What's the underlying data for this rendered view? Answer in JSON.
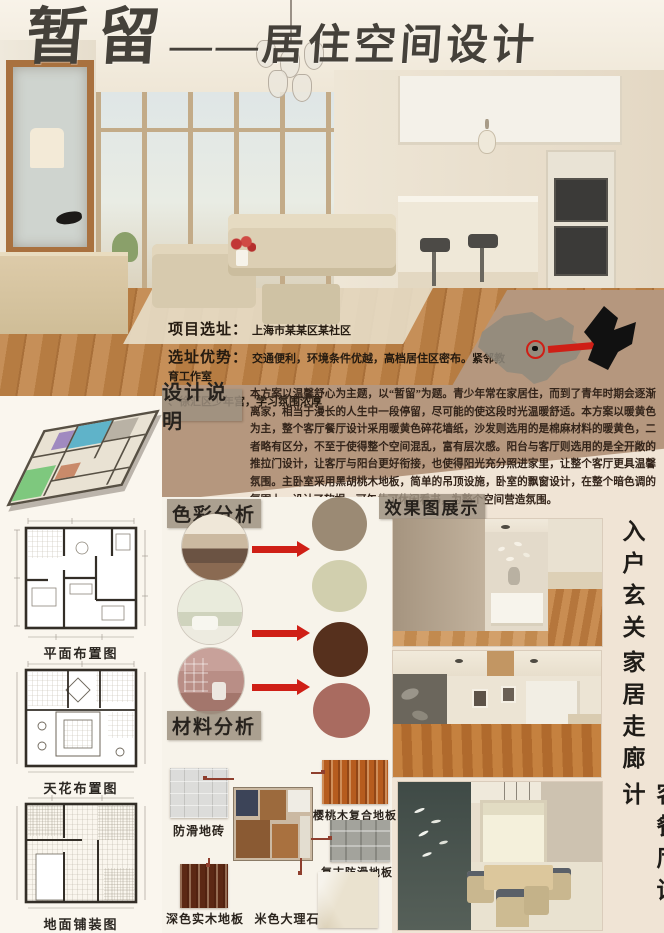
{
  "title": {
    "main": "暂留",
    "separator": "——",
    "sub": "居住空间设计"
  },
  "project": {
    "location_label": "项目选址：",
    "location_value": "上海市某某区某社区",
    "advantage_label": "选址优势：",
    "advantage_value": "交通便利，环境条件优越，高档居住区密布。紧邻教育工作室",
    "advantage_value2": "、徐汇区少年宫，学习氛围浓厚"
  },
  "design_notes": {
    "label": "设计说明",
    "body": "本方案以温馨舒心为主题，以“暂留”为题。青少年常在家居住，而到了青年时期会逐渐离家，相当于漫长的人生中一段停留，尽可能的使这段时光温暖舒适。本方案以暖黄色为主，整个客厅餐厅设计采用暖黄色碎花墙纸，沙发则选用的是棉麻材料的暖黄色，二者略有区分，不至于使得整个空间混乱，富有层次感。阳台与客厅则选用的是全开敞的推拉门设计，让客厅与阳台更好衔接，也使得阳光充分照进家里，让整个客厅更具温馨氛围。主卧室采用黑胡桃木地板，简单的吊顶设施，卧室的飘窗设计，在整个暗色调的氛围上，设计了软榻，可午休可休闲看书，为整个空间营造氛围。"
  },
  "plans": {
    "floor_plan": "平面布置图",
    "ceiling_plan": "天花布置图",
    "paving_plan": "地面铺装图"
  },
  "color_analysis": {
    "label": "色彩分析",
    "swatches": [
      "#9b8a74",
      "#d1cfae",
      "#56301d",
      "#a96b60"
    ]
  },
  "material_analysis": {
    "label": "材料分析",
    "items": [
      {
        "name": "防滑地砖",
        "color": "#dcdcda"
      },
      {
        "name": "樱桃木复合地板",
        "color": "#b65c1e"
      },
      {
        "name": "复古防滑地板",
        "color": "#a3a39c"
      },
      {
        "name": "深色实木地板",
        "color": "#5c2814"
      },
      {
        "name": "米色大理石",
        "color": "#eae2cf"
      }
    ]
  },
  "renders": {
    "label": "效果图展示",
    "captions": [
      "入户玄关",
      "家居走廊",
      "客餐厅设计"
    ]
  },
  "colors": {
    "accent_red": "#cf1f16",
    "tan_band": "#b5977e"
  }
}
